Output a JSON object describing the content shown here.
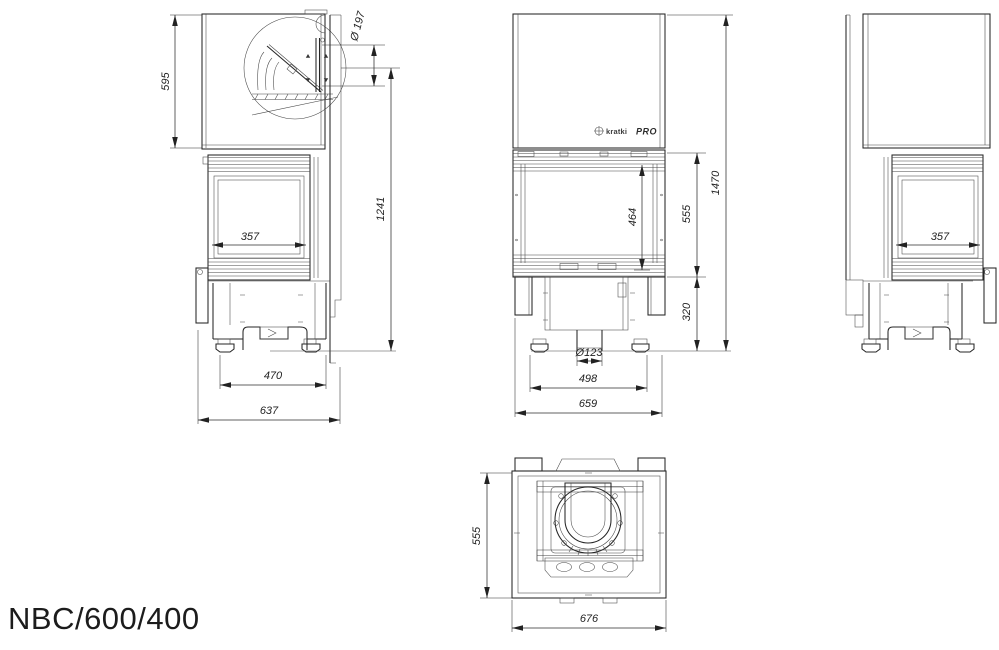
{
  "title": "NBC/600/400",
  "brand": {
    "name": "kratki",
    "suffix": "PRO"
  },
  "dims": {
    "side_left": {
      "hood_height": "595",
      "flue_diameter": "Ø 197",
      "height_to_flue": "1241",
      "glass_width": "357",
      "feet_spacing": "470",
      "depth": "637"
    },
    "front": {
      "glass_height": "464",
      "firebox_height": "555",
      "total_height": "1470",
      "base_height": "320",
      "inlet_diameter": "Ø123",
      "feet_spacing": "498",
      "width": "659"
    },
    "side_right": {
      "glass_width": "357"
    },
    "top": {
      "depth": "555",
      "width": "676"
    }
  }
}
